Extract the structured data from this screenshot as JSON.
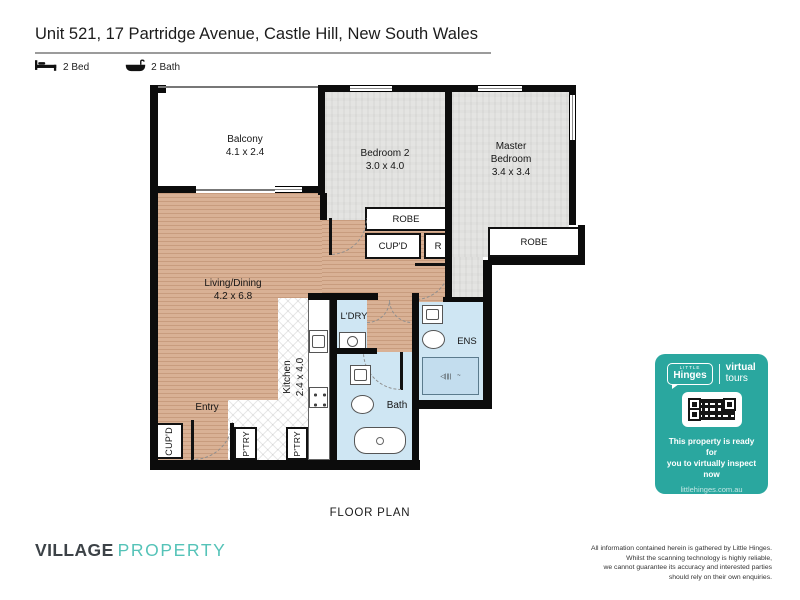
{
  "header": {
    "title": "Unit 521, 17 Partridge Avenue, Castle Hill, New South Wales",
    "features": [
      {
        "icon": "bed-icon",
        "label": "2 Bed"
      },
      {
        "icon": "bath-icon",
        "label": "2 Bath"
      }
    ]
  },
  "floor_plan": {
    "caption": "FLOOR PLAN",
    "rooms": {
      "balcony": {
        "name": "Balcony",
        "dims": "4.1 x 2.4"
      },
      "bedroom2": {
        "name": "Bedroom 2",
        "dims": "3.0 x 4.0"
      },
      "master_bedroom": {
        "name_line1": "Master",
        "name_line2": "Bedroom",
        "dims": "3.4 x 3.4"
      },
      "living_dining": {
        "name": "Living/Dining",
        "dims": "4.2 x 6.8"
      },
      "kitchen": {
        "name": "Kitchen",
        "dims": "2.4 x 4.0"
      },
      "laundry": {
        "name": "L'DRY"
      },
      "ensuite": {
        "name": "ENS"
      },
      "bath": {
        "name": "Bath"
      },
      "entry": {
        "name": "Entry"
      }
    },
    "closets": {
      "bedroom2_robe": "ROBE",
      "master_robe": "ROBE",
      "hall_cupboard": "CUP'D",
      "hall_r": "R",
      "entry_cupboard": "CUP'D",
      "pantry_1": "P'TRY",
      "pantry_2": "P'TRY"
    }
  },
  "virtual_tour_card": {
    "accent_color": "#2aa79f",
    "logo": {
      "brand_small": "LITTLE",
      "brand": "Hinges",
      "product_line1": "virtual",
      "product_line2": "tours"
    },
    "qr_icon": "qr-code",
    "message_line1": "This property is ready for",
    "message_line2": "you to virtually inspect now",
    "website": "littlehinges.com.au"
  },
  "footer": {
    "agency": {
      "primary": "VILLAGE",
      "secondary": "PROPERTY"
    },
    "disclaimer": [
      "All information contained herein is gathered by Little Hinges.",
      "Whilst the scanning technology is highly reliable,",
      "we cannot guarantee its accuracy and interested parties",
      "should rely on their own enquiries."
    ]
  }
}
